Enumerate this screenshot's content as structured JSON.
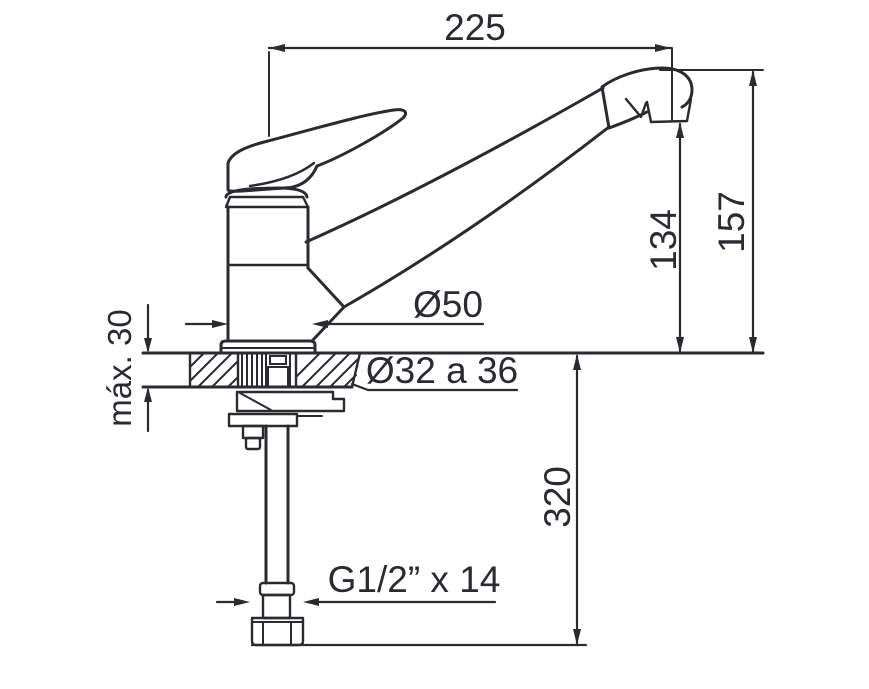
{
  "drawing": {
    "kind": "faucet-installation-technical-drawing",
    "ink_color": "#2a2a30",
    "background_color": "#ffffff",
    "labels": {
      "spout_reach": "225",
      "spout_height": "157",
      "outlet_height": "134",
      "body_diameter": "Ø50",
      "hole_diameter": "Ø32 a 36",
      "max_counter_thickness": "máx. 30",
      "supply_length": "320",
      "thread_spec": "G1/2” x 14"
    }
  }
}
